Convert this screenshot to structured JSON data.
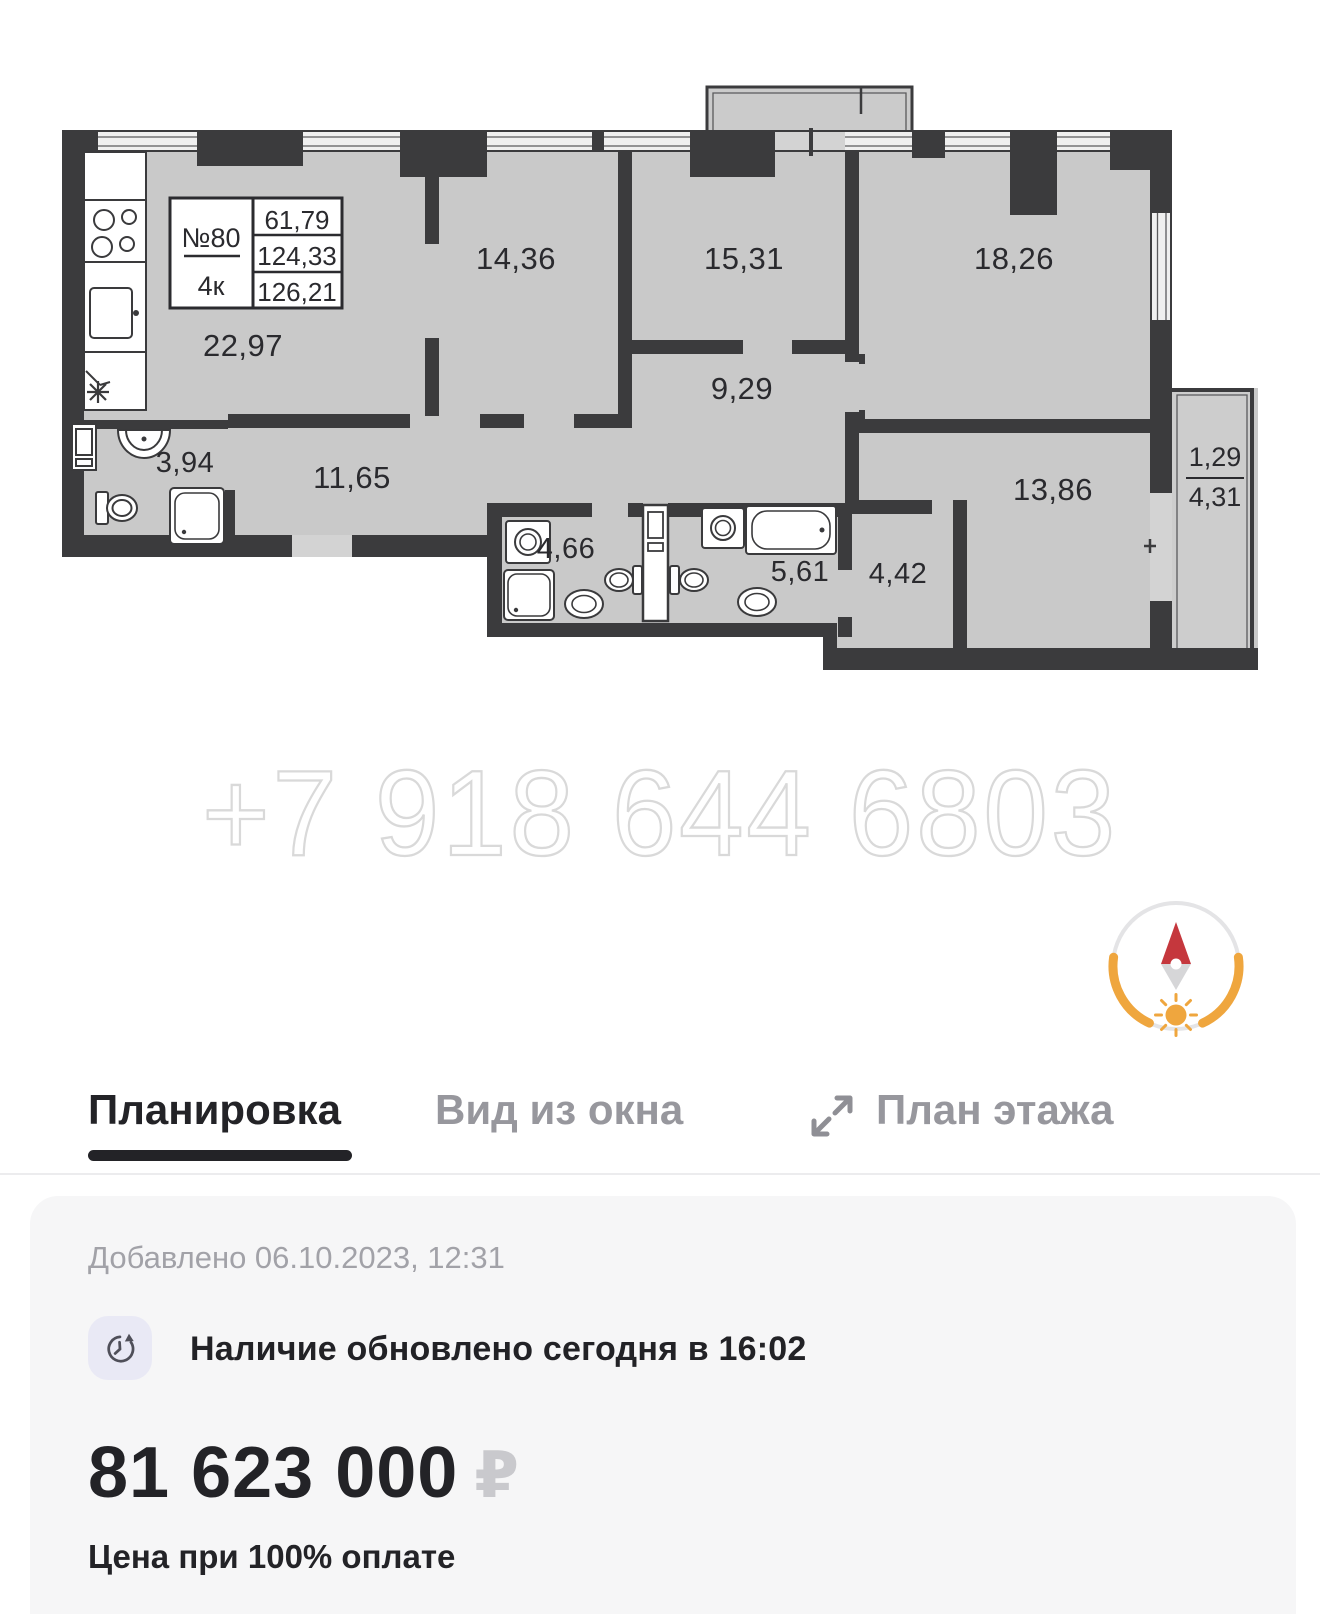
{
  "plan": {
    "unit": {
      "number": "№80",
      "rooms_label": "4к",
      "living_area": "61,79",
      "area_without_balcony": "124,33",
      "total_area": "126,21"
    },
    "rooms": [
      {
        "name": "kitchen-living-room",
        "area": "22,97"
      },
      {
        "name": "bedroom-1",
        "area": "14,36"
      },
      {
        "name": "bedroom-2",
        "area": "15,31"
      },
      {
        "name": "bedroom-3",
        "area": "18,26"
      },
      {
        "name": "corridor",
        "area": "9,29"
      },
      {
        "name": "hallway",
        "area": "11,65"
      },
      {
        "name": "bathroom-1",
        "area": "3,94"
      },
      {
        "name": "bathroom-2",
        "area": "4,66"
      },
      {
        "name": "bathroom-3",
        "area": "5,61"
      },
      {
        "name": "hall",
        "area": "4,42"
      },
      {
        "name": "bedroom-4",
        "area": "13,86"
      }
    ],
    "balcony": {
      "reduced_area": "1,29",
      "area": "4,31"
    }
  },
  "watermark": {
    "phone": "+7 918 644 6803"
  },
  "tabs": [
    {
      "label": "Планировка",
      "active": true
    },
    {
      "label": "Вид из окна",
      "active": false
    },
    {
      "label": "План этажа",
      "active": false
    }
  ],
  "card": {
    "added": "Добавлено 06.10.2023, 12:31",
    "availability": "Наличие обновлено сегодня в 16:02",
    "price": "81 623 000",
    "currency": "₽",
    "price_note": "Цена при 100% оплате"
  },
  "colors": {
    "plan_fill": "#c9c9c9",
    "wall": "#3b3b3d",
    "accent_red": "#c5373d",
    "accent_orange": "#efa63e",
    "tab_active": "#232327",
    "tab_inactive": "#97979d",
    "card_bg": "#f6f6f7",
    "watermark": "#d9d9d9",
    "currency_gray": "#c9c9cd",
    "icon_bg": "#e9e9f5"
  }
}
